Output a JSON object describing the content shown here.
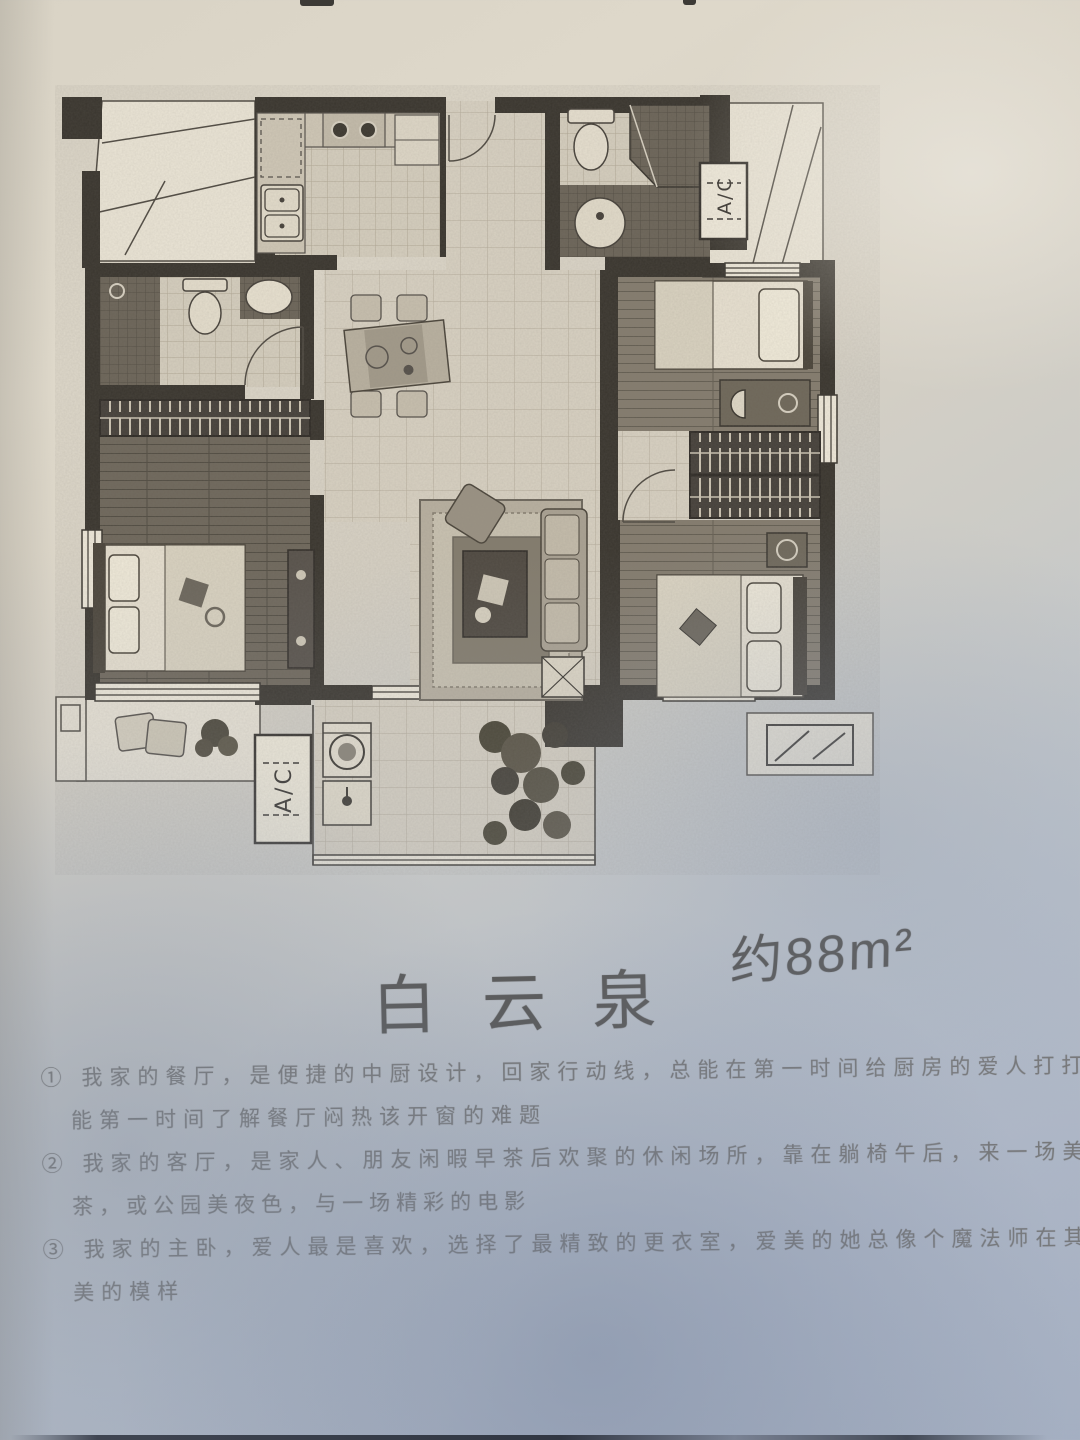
{
  "document": {
    "title": "白云泉",
    "area_label": "约88m²",
    "plan": {
      "ac_label": "A/C"
    },
    "notes": {
      "lines": [
        "① 我家的餐厅，是便捷的中厨设计，回家行动线，总能在第一时间给厨房的爱人打打下手，也",
        "能第一时间了解餐厅闷热该开窗的难题",
        "② 我家的客厅，是家人、朋友闲暇早茶后欢聚的休闲场所，靠在躺椅午后，来一场美好的下午",
        "茶，或公园美夜色，与一场精彩的电影",
        "③ 我家的主卧，爱人最是喜欢，选择了最精致的更衣室，爱美的她总像个魔法师在其中变出最",
        "美的模样"
      ]
    }
  }
}
